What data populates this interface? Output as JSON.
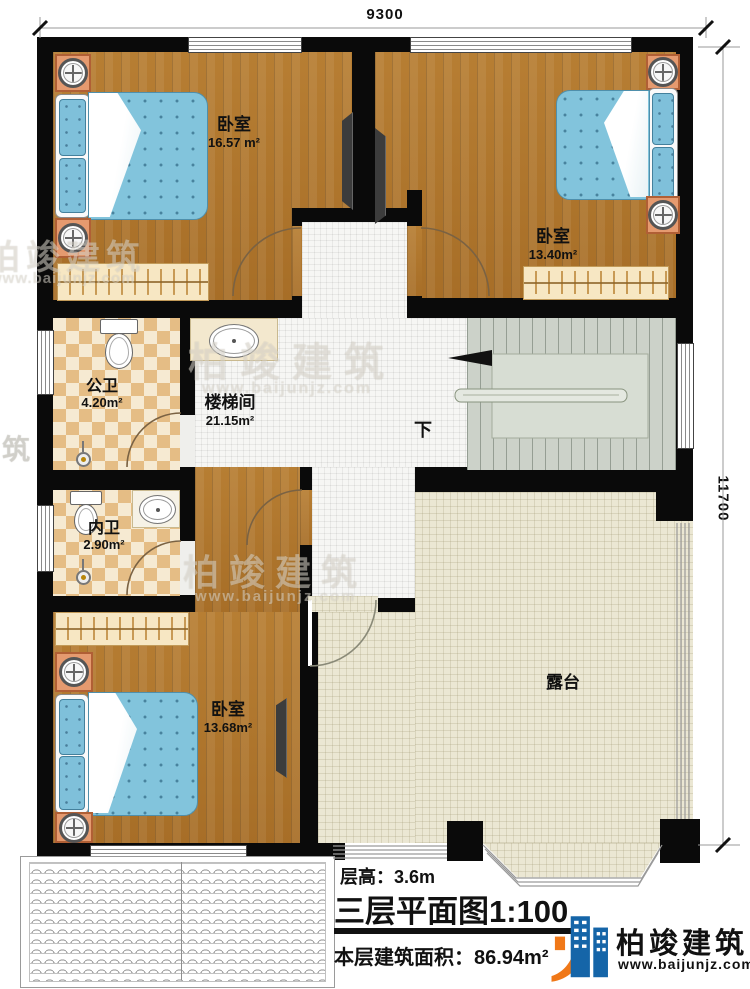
{
  "dimensions": {
    "width_label": "9300",
    "height_label": "11700"
  },
  "rooms": {
    "bedroom_top_left": {
      "label": "卧室",
      "area": "16.57 m²"
    },
    "bedroom_top_right": {
      "label": "卧室",
      "area": "13.40m²"
    },
    "public_bathroom": {
      "label": "公卫",
      "area": "4.20m²"
    },
    "stairwell": {
      "label": "楼梯间",
      "area": "21.15m²",
      "direction": "下"
    },
    "ensuite_bathroom": {
      "label": "内卫",
      "area": "2.90m²"
    },
    "bedroom_bottom": {
      "label": "卧室",
      "area": "13.68m²"
    },
    "terrace": {
      "label": "露台"
    }
  },
  "title_block": {
    "floor_height": "层高：3.6m",
    "plan_title": "三层平面图",
    "plan_scale": "1:100",
    "floor_area": "本层建筑面积：86.94m²"
  },
  "brand": {
    "name": "柏竣建筑",
    "website": "www.baijunjz.com"
  },
  "watermark": {
    "name": "柏竣建筑",
    "website": "www.baijunjz.com",
    "partial": "筑"
  },
  "colors": {
    "wall": "#0a0a0a",
    "wood": "#ad742e",
    "white_tile": "#f6f6f4",
    "checker_tile": "#e5bd85",
    "stair": "#ccd2c9",
    "terrace": "#ebe7d3",
    "bed_blue": "#82c4dc",
    "nightstand": "#e59a6f",
    "wardrobe": "#f7e7c3",
    "brand_blue": "#1565a8",
    "brand_orange": "#f07818"
  }
}
